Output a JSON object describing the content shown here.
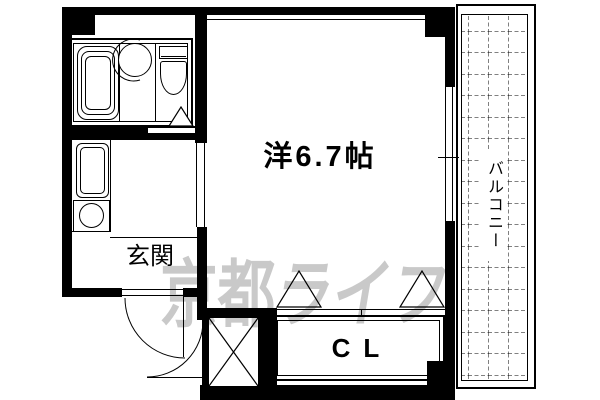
{
  "plan": {
    "room_label": "洋6.7帖",
    "entrance_label": "玄関",
    "closet_label": "CL",
    "balcony_label": "バルコニー",
    "watermark": {
      "part1": "京都",
      "part2": "ライフ"
    },
    "colors": {
      "line": "#000000",
      "background": "#ffffff",
      "watermark": "#c9c9c9"
    }
  }
}
